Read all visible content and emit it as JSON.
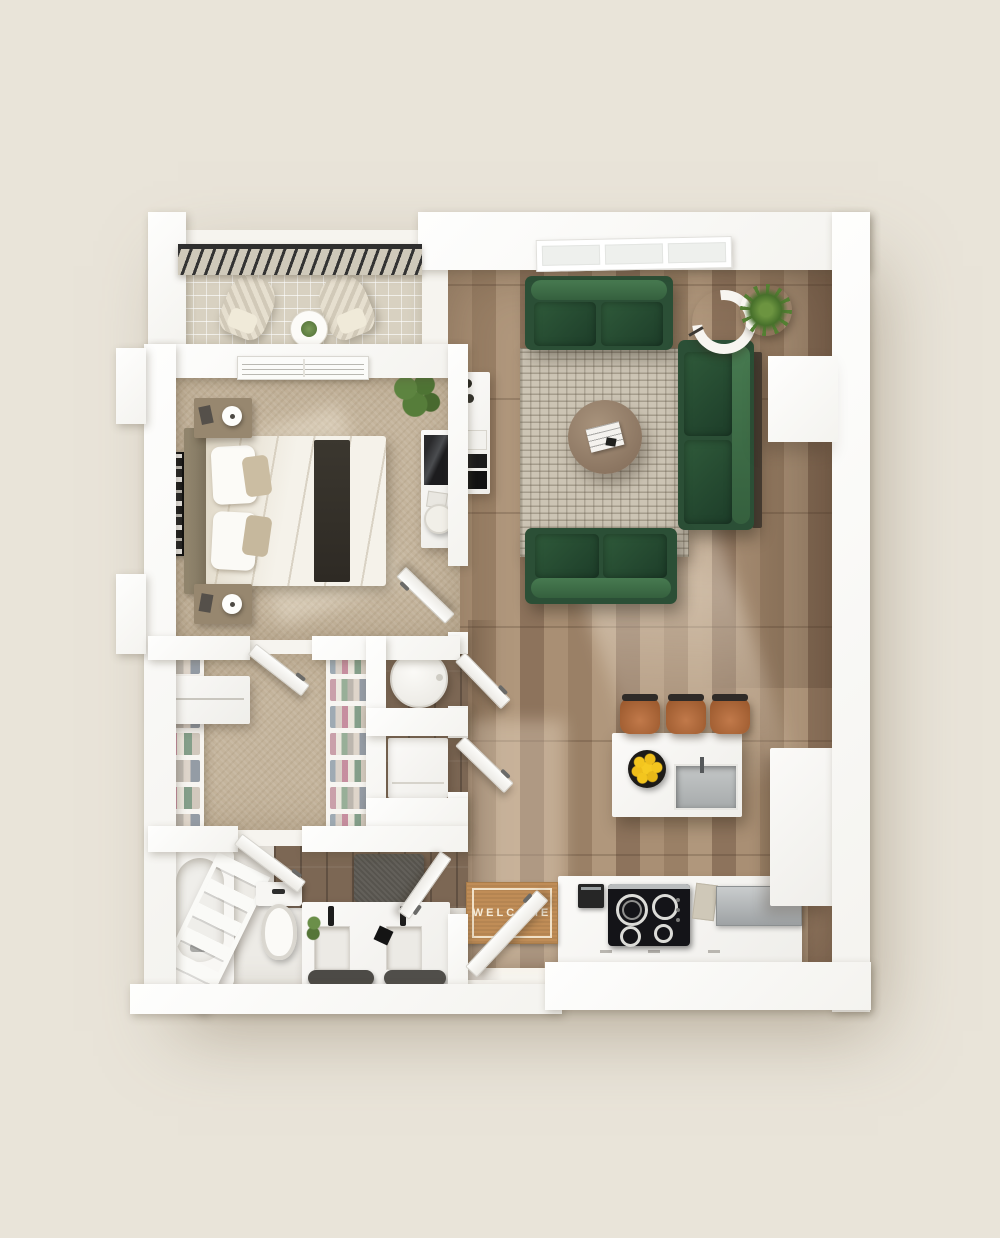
{
  "scene": {
    "type": "3d-apartment-floor-plan-top-view",
    "background": "#e9e4d9",
    "wall_color": "#ffffff"
  },
  "palette": {
    "wood_floor": "#9f8569",
    "dark_tile": "#7c6754",
    "carpet": "#c4b49c",
    "balcony_tile": "#d8d1c1",
    "sofa_green": "#2b4f36",
    "rug_beige": "#ccc4b4",
    "stool_leather": "#b06a3b",
    "mat_coir": "#c08d57",
    "lemon_yellow": "#f2c41f",
    "towel_gray": "#4c4a46",
    "cooktop_black": "#141418",
    "stainless": "#b9bdbe",
    "plant_green": "#5d7f3a"
  },
  "entry": {
    "mat_text": "WELCOME"
  },
  "inventory": {
    "balcony": {
      "items": [
        "railing",
        "lounge-chair",
        "lounge-chair",
        "round-table",
        "potted-plant"
      ]
    },
    "bedroom": {
      "items": [
        "double-bed",
        "headboard",
        "throw-runner",
        "pillows",
        "nightstand",
        "table-lamp",
        "nightstand",
        "table-lamp",
        "wall-art",
        "potted-plant",
        "desk",
        "tv",
        "desk-chair",
        "air-vent"
      ]
    },
    "living_room": {
      "items": [
        "sofa",
        "chaise-sofa",
        "loveseat",
        "area-rug",
        "round-coffee-table",
        "magazine",
        "arc-floor-lamp",
        "potted-plant",
        "media-console",
        "wall-column"
      ],
      "window_panes": 3
    },
    "closet": {
      "items": [
        "shelving-unit",
        "shelving-unit",
        "corner-shelf",
        "door"
      ]
    },
    "laundry_nooks": {
      "items": [
        "round-appliance",
        "cabinet-appliance",
        "door",
        "door"
      ]
    },
    "bathroom": {
      "items": [
        "bathtub",
        "ladder-rack",
        "toilet",
        "bath-mat",
        "double-vanity",
        "sink",
        "sink",
        "black-faucet",
        "black-faucet",
        "towel",
        "towel",
        "plant",
        "door",
        "door",
        "air-vent"
      ]
    },
    "kitchen": {
      "items": [
        "island",
        "island-sink",
        "lemon-bowl",
        "cooktop",
        "coffee-machine",
        "counter",
        "stainless-counter",
        "pantry-cabinet"
      ],
      "bar_stools": 3,
      "cooktop_burners": 4,
      "lemons": 7
    }
  }
}
